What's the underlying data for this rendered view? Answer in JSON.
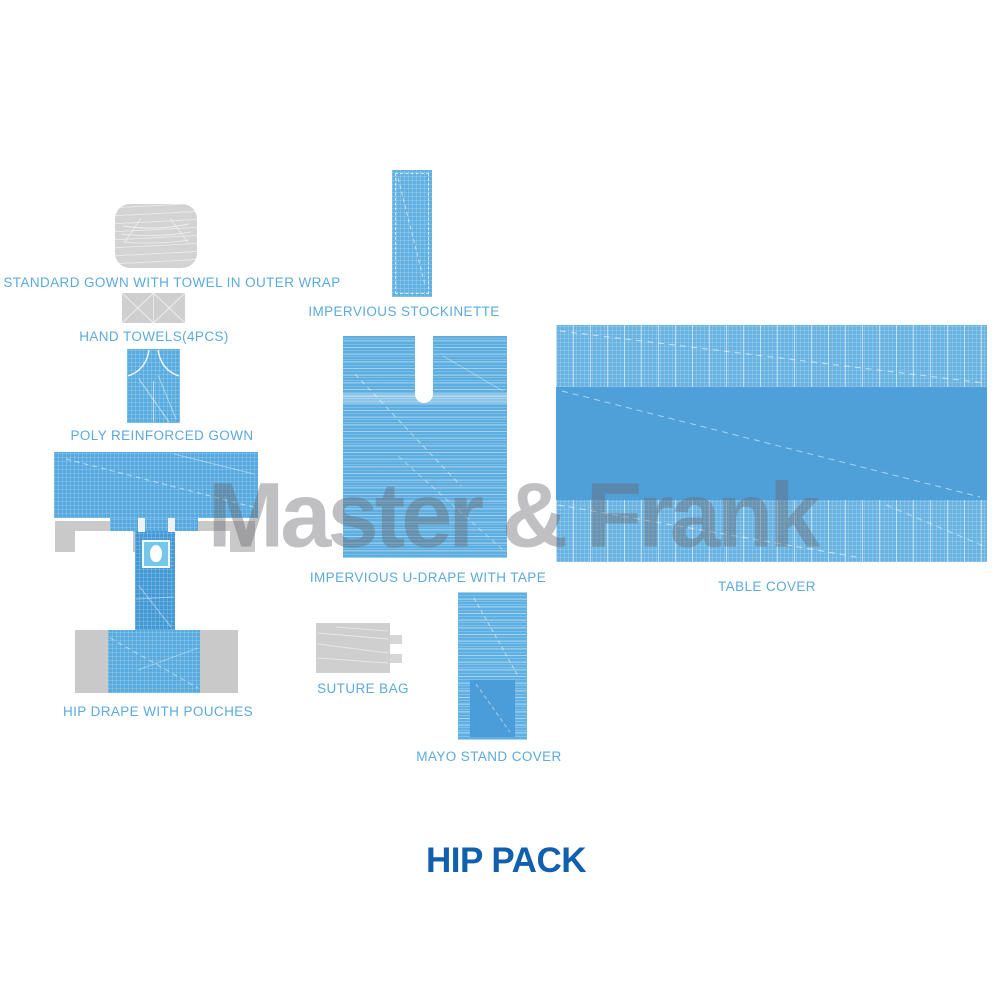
{
  "title": "HIP PACK",
  "watermark": "Master & Frank",
  "colors": {
    "label_text": "#5caade",
    "title_text": "#1160ae",
    "drape_light": "#5fb0e2",
    "drape_band_light": "#68b3e2",
    "drape_medium": "#4f9fd9",
    "drape_dark": "#4399d6",
    "fenestration_film": "#74c7e8",
    "gray_item": "#cfcfcf",
    "watermark_gray": "#9a9c9e"
  },
  "items": [
    {
      "id": "standard-gown",
      "label": "STANDARD GOWN WITH TOWEL IN OUTER WRAP"
    },
    {
      "id": "hand-towels",
      "label": "HAND TOWELS(4PCS)"
    },
    {
      "id": "poly-reinforced-gown",
      "label": "POLY REINFORCED GOWN"
    },
    {
      "id": "hip-drape",
      "label": "HIP DRAPE WITH POUCHES"
    },
    {
      "id": "impervious-stockinette",
      "label": "IMPERVIOUS STOCKINETTE"
    },
    {
      "id": "impervious-u-drape",
      "label": "IMPERVIOUS U-DRAPE WITH TAPE"
    },
    {
      "id": "table-cover",
      "label": "TABLE COVER"
    },
    {
      "id": "suture-bag",
      "label": "SUTURE BAG"
    },
    {
      "id": "mayo-stand-cover",
      "label": "MAYO STAND COVER"
    }
  ]
}
